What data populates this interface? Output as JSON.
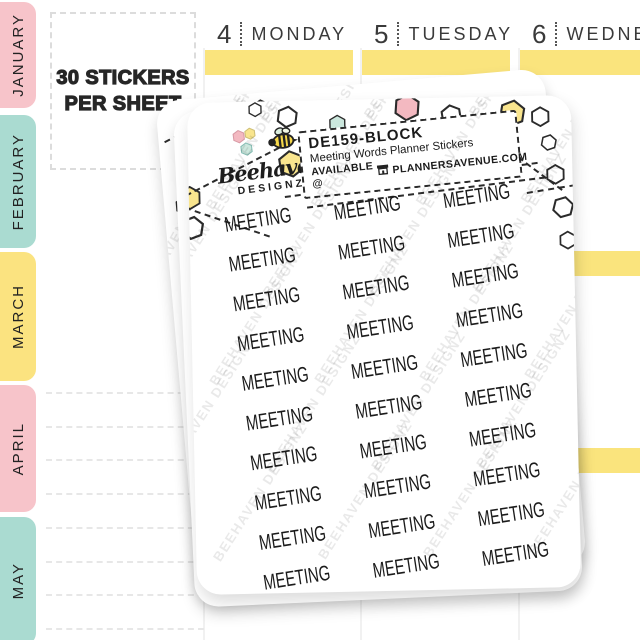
{
  "colors": {
    "highlight": "#FAE47D",
    "tab-pink": "#F7C4CA",
    "tab-teal": "#AADBD1",
    "tab-yellow": "#FBE380",
    "hex-yellow": "#F9E58E",
    "hex-pink": "#F3B9C1",
    "hex-mint": "#CBE7DD",
    "ink": "#2B2B2B"
  },
  "month_tabs": [
    {
      "label": "JANUARY",
      "color": "#F7C4CA"
    },
    {
      "label": "FEBRUARY",
      "color": "#AADBD1"
    },
    {
      "label": "MARCH",
      "color": "#FBE380"
    },
    {
      "label": "APRIL",
      "color": "#F7C4CA"
    },
    {
      "label": "MAY",
      "color": "#AADBD1"
    }
  ],
  "note": {
    "line1": "30 STICKERS",
    "line2": "PER SHEET"
  },
  "calendar": {
    "days": [
      {
        "number": "4",
        "name": "MONDAY"
      },
      {
        "number": "5",
        "name": "TUESDAY"
      },
      {
        "number": "6",
        "name": "WEDNESDAY"
      }
    ]
  },
  "sheet": {
    "brand": {
      "name": "Beehaven",
      "subname": "DESIGNZ"
    },
    "label": {
      "sku": "DE159-BLOCK",
      "title": "Meeting Words Planner Stickers",
      "available_prefix": "AVAILABLE @",
      "site": "PLANNERSAVENUE.COM"
    },
    "stickers": {
      "word": "MEETING",
      "count": 30,
      "columns": 3
    },
    "watermark": "BEEHAVEN DESIGNZ"
  }
}
